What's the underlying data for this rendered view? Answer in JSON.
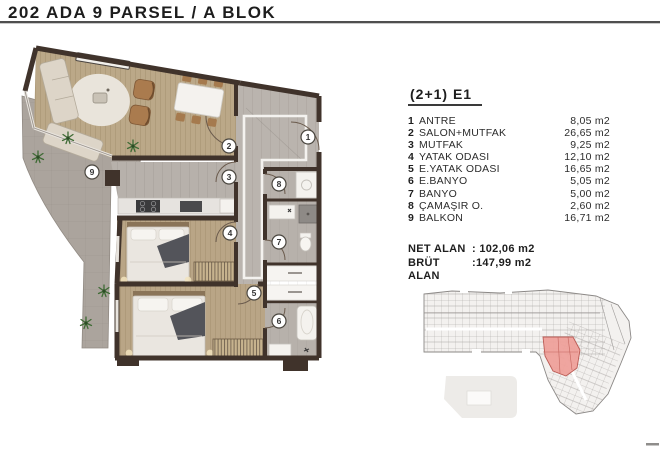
{
  "title": "202 ADA 9 PARSEL / A BLOK",
  "unit": {
    "type_label": "(2+1) E1",
    "rooms": [
      {
        "no": "1",
        "name": "ANTRE",
        "area": "8,05 m2"
      },
      {
        "no": "2",
        "name": "SALON+MUTFAK",
        "area": "26,65 m2"
      },
      {
        "no": "3",
        "name": "MUTFAK",
        "area": "9,25 m2"
      },
      {
        "no": "4",
        "name": "YATAK ODASI",
        "area": "12,10 m2"
      },
      {
        "no": "5",
        "name": "E.YATAK ODASI",
        "area": "16,65 m2"
      },
      {
        "no": "6",
        "name": "E.BANYO",
        "area": "5,05 m2"
      },
      {
        "no": "7",
        "name": "BANYO",
        "area": "5,00 m2"
      },
      {
        "no": "8",
        "name": "ÇAMAŞIR O.",
        "area": "2,60 m2"
      },
      {
        "no": "9",
        "name": "BALKON",
        "area": "16,71 m2"
      }
    ],
    "totals": [
      {
        "label": "NET ALAN",
        "value": ": 102,06 m2"
      },
      {
        "label": "BRÜT ALAN",
        "value": ":147,99 m2"
      }
    ]
  },
  "floor_plan": {
    "labels": [
      "1",
      "2",
      "3",
      "4",
      "5",
      "6",
      "7",
      "8",
      "9"
    ]
  },
  "colors": {
    "wall": "#40332b",
    "wood_floor": "#b9a586",
    "tile_floor": "#b7b1ab",
    "balcony_floor": "#aba49d",
    "title_rule": "#4f4f4f",
    "highlight_red": "#efa19b"
  }
}
